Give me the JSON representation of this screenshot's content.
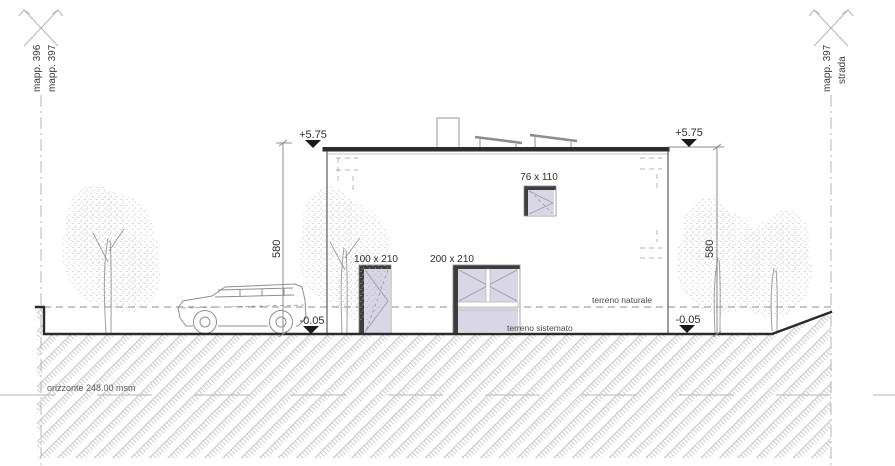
{
  "drawing": {
    "boundary_left": {
      "label_a": "mapp. 396",
      "label_b": "mapp. 397"
    },
    "boundary_right": {
      "label_a": "mapp. 397",
      "label_b": "strada"
    },
    "levels": {
      "roof_left": "+5.75",
      "roof_right": "+5.75",
      "ground_left": "-0.05",
      "ground_right": "-0.05",
      "height_left": "580",
      "height_right": "580",
      "horizon": "orizzonte 248.00 msm"
    },
    "terrain": {
      "natural": "terreno naturale",
      "finished": "terreno sistemato"
    },
    "openings": {
      "roof_window": "76 x 110",
      "entry_door": "100 x 210",
      "garage_door": "200 x 210"
    },
    "colors": {
      "line_dark": "#2b2b2b",
      "line_medium": "#8c8c8c",
      "line_light": "#b5b5b5",
      "hatch": "#c2c2c2",
      "foliage": "#ababab",
      "glass_fill": "#d9d7e6",
      "frame_dark": "#3d3d3d",
      "marker_fill": "#1a1a1a"
    }
  }
}
